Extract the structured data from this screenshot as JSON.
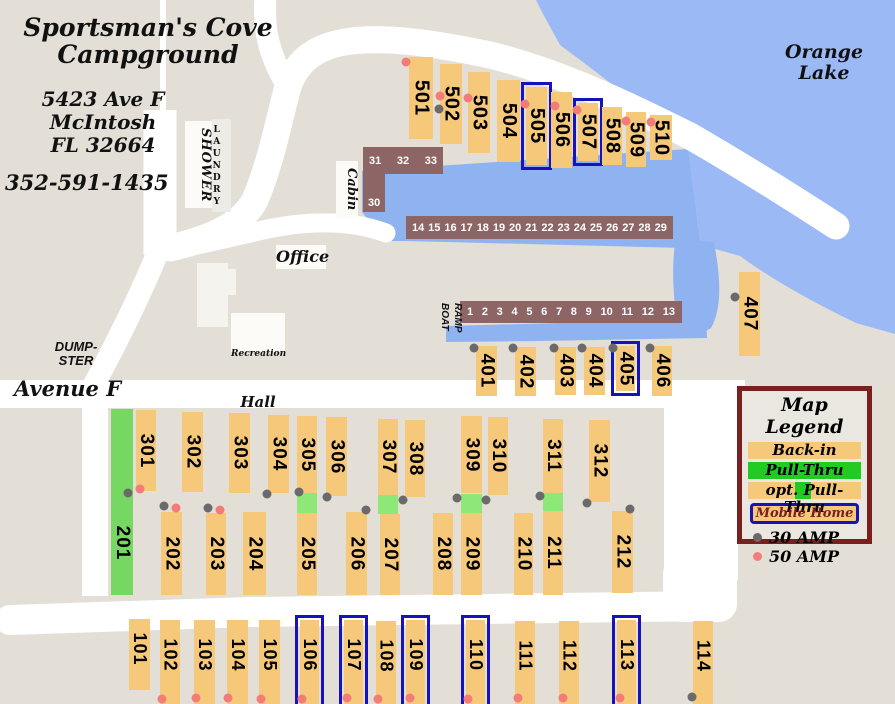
{
  "colors": {
    "land": "#e3dfd7",
    "lake": "#9bbaf5",
    "water": "#8fb3f1",
    "road": "#ffffff",
    "orange": "#f6c87a",
    "pullgreen": "#76d863",
    "optgreen": "#8de878",
    "leggreen": "#21cb21",
    "blue": "#1813b8",
    "maroon": "#7a1f1f",
    "dock": "#8e6565",
    "gray30": "#6a6a6a",
    "red50": "#f37c78"
  },
  "header": {
    "title": "Sportsman's Cove\nCampground",
    "address": "5423 Ave F\nMcIntosh\nFL 32664",
    "phone": "352-591-1435"
  },
  "labels": {
    "lake": "Orange\nLake",
    "office": "Office",
    "recreation1": "Recreation",
    "recreation2": "Hall",
    "dumpster": "DUMP-\nSTER",
    "avenue": "Avenue F",
    "shower": "SHOWER",
    "laundry": "LAUNDRY",
    "cabin": "Cabin",
    "boat_ramp": "BOAT\nRAMP"
  },
  "legend": {
    "title": "Map Legend",
    "back_in": "Back-in",
    "pull_thru": "Pull-Thru",
    "opt_pull_thru": "opt. Pull-Thru",
    "mobile_home": "Mobile Home",
    "amp30": "30 AMP",
    "amp50": "50 AMP"
  },
  "docks": {
    "upper": [
      "14",
      "15",
      "16",
      "17",
      "18",
      "19",
      "20",
      "21",
      "22",
      "23",
      "24",
      "25",
      "26",
      "27",
      "28",
      "29"
    ],
    "lower": [
      "1",
      "2",
      "3",
      "4",
      "5",
      "6",
      "7",
      "8",
      "9",
      "10",
      "11",
      "12",
      "13"
    ],
    "cabin_top": [
      "31",
      "32",
      "33"
    ],
    "cabin_bottom": "30"
  },
  "sites": [
    {
      "label": "501",
      "x": 409,
      "y": 57,
      "w": 24,
      "h": 82
    },
    {
      "label": "502",
      "x": 440,
      "y": 64,
      "w": 22,
      "h": 80
    },
    {
      "label": "503",
      "x": 468,
      "y": 72,
      "w": 22,
      "h": 81
    },
    {
      "label": "504",
      "x": 497,
      "y": 80,
      "w": 23,
      "h": 82
    },
    {
      "label": "505",
      "x": 526,
      "y": 87,
      "w": 21,
      "h": 78,
      "mobile": true
    },
    {
      "label": "506",
      "x": 551,
      "y": 92,
      "w": 21,
      "h": 76
    },
    {
      "label": "507",
      "x": 578,
      "y": 103,
      "w": 20,
      "h": 58,
      "mobile": true
    },
    {
      "label": "508",
      "x": 602,
      "y": 107,
      "w": 20,
      "h": 58
    },
    {
      "label": "509",
      "x": 626,
      "y": 112,
      "w": 20,
      "h": 55
    },
    {
      "label": "510",
      "x": 650,
      "y": 115,
      "w": 22,
      "h": 45
    },
    {
      "label": "401",
      "x": 476,
      "y": 346,
      "w": 21,
      "h": 50
    },
    {
      "label": "402",
      "x": 515,
      "y": 347,
      "w": 21,
      "h": 49
    },
    {
      "label": "403",
      "x": 555,
      "y": 347,
      "w": 21,
      "h": 48
    },
    {
      "label": "404",
      "x": 584,
      "y": 347,
      "w": 21,
      "h": 48
    },
    {
      "label": "405",
      "x": 616,
      "y": 346,
      "w": 19,
      "h": 45,
      "mobile": true
    },
    {
      "label": "406",
      "x": 652,
      "y": 346,
      "w": 20,
      "h": 50
    },
    {
      "label": "407",
      "x": 739,
      "y": 272,
      "w": 21,
      "h": 84
    },
    {
      "label": "301",
      "x": 136,
      "y": 410,
      "w": 20,
      "h": 81
    },
    {
      "label": "302",
      "x": 182,
      "y": 412,
      "w": 21,
      "h": 80
    },
    {
      "label": "303",
      "x": 229,
      "y": 413,
      "w": 21,
      "h": 80
    },
    {
      "label": "304",
      "x": 268,
      "y": 415,
      "w": 21,
      "h": 78
    },
    {
      "label": "305",
      "x": 297,
      "y": 416,
      "w": 20,
      "h": 77
    },
    {
      "label": "306",
      "x": 326,
      "y": 417,
      "w": 21,
      "h": 79
    },
    {
      "label": "307",
      "x": 378,
      "y": 419,
      "w": 20,
      "h": 76
    },
    {
      "label": "308",
      "x": 405,
      "y": 420,
      "w": 20,
      "h": 77
    },
    {
      "label": "309",
      "x": 461,
      "y": 416,
      "w": 21,
      "h": 77
    },
    {
      "label": "310",
      "x": 488,
      "y": 417,
      "w": 20,
      "h": 78
    },
    {
      "label": "311",
      "x": 543,
      "y": 419,
      "w": 20,
      "h": 74
    },
    {
      "label": "312",
      "x": 589,
      "y": 420,
      "w": 21,
      "h": 82
    },
    {
      "label": "201",
      "x": 111,
      "y": 409,
      "w": 22,
      "h": 186,
      "type": "pullthru",
      "ly": 0.72
    },
    {
      "label": "202",
      "x": 161,
      "y": 512,
      "w": 21,
      "h": 83
    },
    {
      "label": "203",
      "x": 206,
      "y": 513,
      "w": 20,
      "h": 82
    },
    {
      "label": "204",
      "x": 243,
      "y": 512,
      "w": 23,
      "h": 83
    },
    {
      "label": "205",
      "x": 297,
      "y": 513,
      "w": 20,
      "h": 82
    },
    {
      "label": "206",
      "x": 346,
      "y": 512,
      "w": 21,
      "h": 83
    },
    {
      "label": "207",
      "x": 380,
      "y": 514,
      "w": 20,
      "h": 81
    },
    {
      "label": "208",
      "x": 433,
      "y": 513,
      "w": 20,
      "h": 82
    },
    {
      "label": "209",
      "x": 461,
      "y": 513,
      "w": 21,
      "h": 82
    },
    {
      "label": "210",
      "x": 514,
      "y": 513,
      "w": 19,
      "h": 82
    },
    {
      "label": "211",
      "x": 543,
      "y": 511,
      "w": 20,
      "h": 84
    },
    {
      "label": "212",
      "x": 612,
      "y": 511,
      "w": 21,
      "h": 82
    },
    {
      "label": "101",
      "x": 129,
      "y": 619,
      "w": 21,
      "h": 71,
      "ly": 0.42
    },
    {
      "label": "102",
      "x": 160,
      "y": 620,
      "w": 20,
      "h": 84,
      "ly": 0.42
    },
    {
      "label": "103",
      "x": 194,
      "y": 620,
      "w": 21,
      "h": 84,
      "ly": 0.42
    },
    {
      "label": "104",
      "x": 227,
      "y": 620,
      "w": 21,
      "h": 84,
      "ly": 0.42
    },
    {
      "label": "105",
      "x": 259,
      "y": 620,
      "w": 21,
      "h": 84,
      "ly": 0.42
    },
    {
      "label": "106",
      "x": 300,
      "y": 620,
      "w": 19,
      "h": 84,
      "mobile": true,
      "ly": 0.42
    },
    {
      "label": "107",
      "x": 344,
      "y": 620,
      "w": 19,
      "h": 84,
      "mobile": true,
      "ly": 0.42
    },
    {
      "label": "108",
      "x": 376,
      "y": 621,
      "w": 20,
      "h": 83,
      "ly": 0.42
    },
    {
      "label": "109",
      "x": 406,
      "y": 620,
      "w": 19,
      "h": 84,
      "mobile": true,
      "ly": 0.42
    },
    {
      "label": "110",
      "x": 466,
      "y": 620,
      "w": 19,
      "h": 84,
      "mobile": true,
      "ly": 0.42
    },
    {
      "label": "111",
      "x": 515,
      "y": 621,
      "w": 20,
      "h": 83,
      "ly": 0.42
    },
    {
      "label": "112",
      "x": 559,
      "y": 621,
      "w": 20,
      "h": 83,
      "ly": 0.42
    },
    {
      "label": "113",
      "x": 617,
      "y": 620,
      "w": 19,
      "h": 84,
      "mobile": true,
      "ly": 0.42
    },
    {
      "label": "114",
      "x": 693,
      "y": 621,
      "w": 20,
      "h": 83,
      "ly": 0.42
    }
  ],
  "green_patches": [
    {
      "x": 297,
      "y": 493,
      "w": 20,
      "h": 20
    },
    {
      "x": 378,
      "y": 495,
      "w": 20,
      "h": 19
    },
    {
      "x": 461,
      "y": 494,
      "w": 21,
      "h": 19
    },
    {
      "x": 543,
      "y": 493,
      "w": 20,
      "h": 18
    }
  ],
  "dots": {
    "gray": [
      [
        439,
        109
      ],
      [
        735,
        297
      ],
      [
        474,
        348
      ],
      [
        513,
        348
      ],
      [
        554,
        348
      ],
      [
        582,
        348
      ],
      [
        613,
        348
      ],
      [
        650,
        348
      ],
      [
        128,
        493
      ],
      [
        164,
        506
      ],
      [
        208,
        508
      ],
      [
        267,
        494
      ],
      [
        299,
        492
      ],
      [
        327,
        497
      ],
      [
        366,
        510
      ],
      [
        403,
        500
      ],
      [
        457,
        498
      ],
      [
        486,
        500
      ],
      [
        540,
        496
      ],
      [
        587,
        503
      ],
      [
        630,
        509
      ],
      [
        692,
        697
      ]
    ],
    "red": [
      [
        406,
        62
      ],
      [
        440,
        96
      ],
      [
        468,
        98
      ],
      [
        525,
        104
      ],
      [
        555,
        106
      ],
      [
        577,
        110
      ],
      [
        626,
        121
      ],
      [
        651,
        122
      ],
      [
        140,
        489
      ],
      [
        176,
        508
      ],
      [
        220,
        510
      ],
      [
        162,
        699
      ],
      [
        196,
        698
      ],
      [
        228,
        698
      ],
      [
        261,
        699
      ],
      [
        302,
        699
      ],
      [
        347,
        698
      ],
      [
        378,
        699
      ],
      [
        410,
        698
      ],
      [
        468,
        699
      ],
      [
        518,
        698
      ],
      [
        563,
        698
      ],
      [
        620,
        698
      ]
    ]
  }
}
